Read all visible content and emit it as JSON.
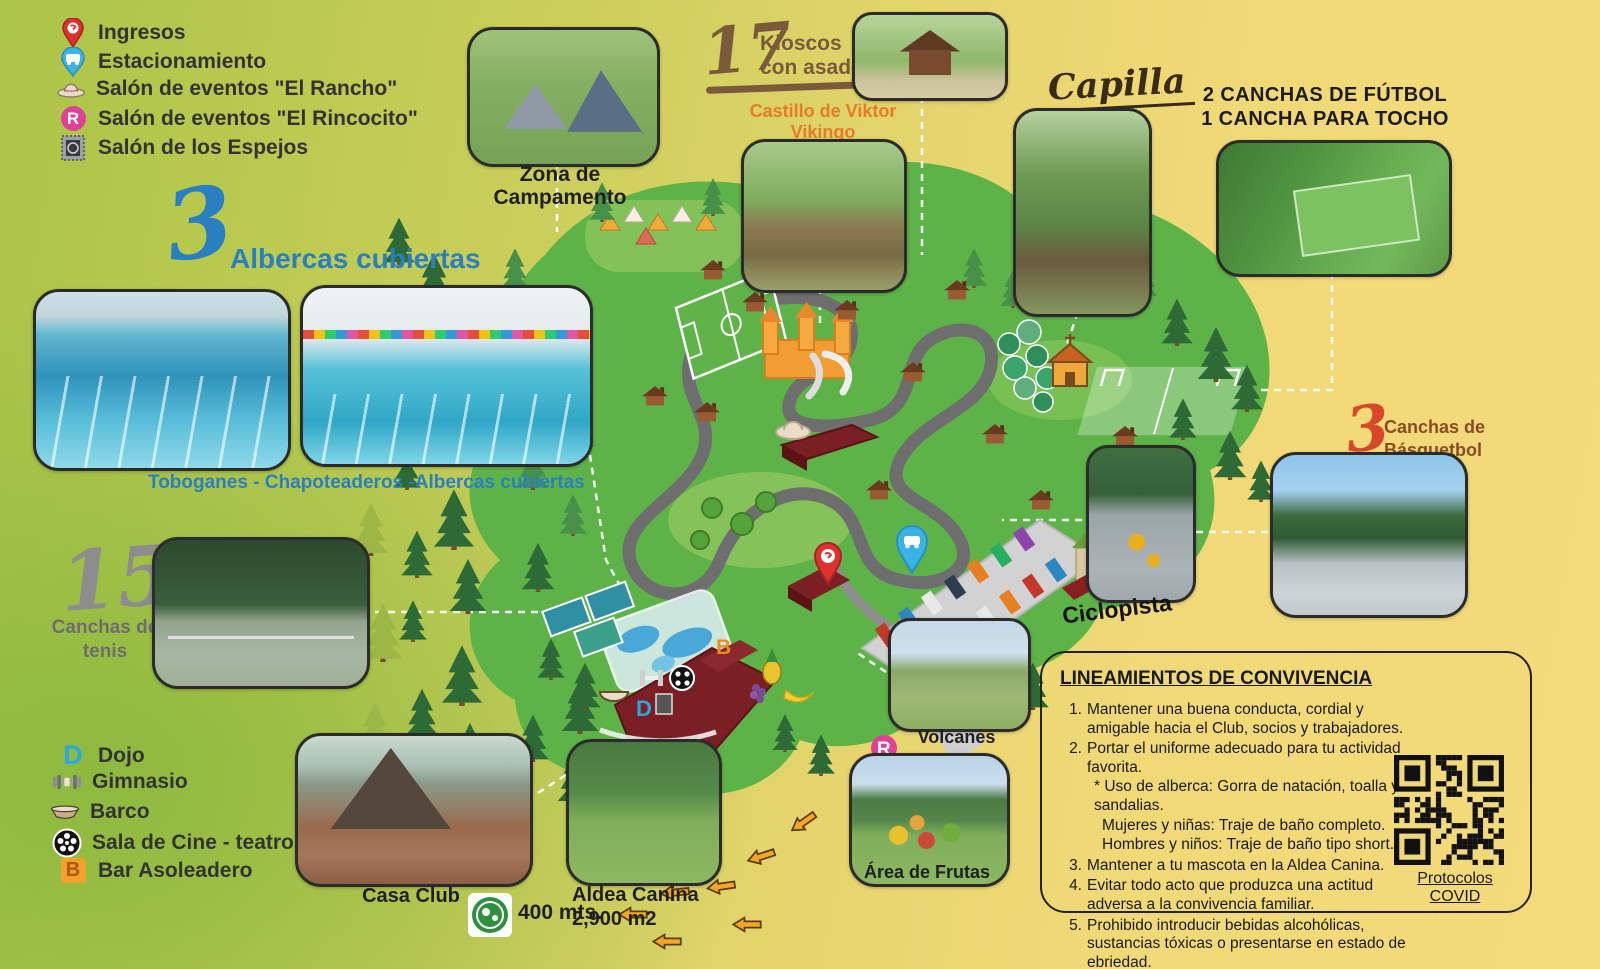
{
  "legend_top": {
    "items": [
      {
        "icon": "location-pin",
        "label": "Ingresos"
      },
      {
        "icon": "parking-pin",
        "label": "Estacionamiento"
      },
      {
        "icon": "cowboy-hat",
        "label": "Salón de eventos \"El Rancho\""
      },
      {
        "icon": "r-badge",
        "label": "Salón de eventos  \"El Rincocito\""
      },
      {
        "icon": "mirrors",
        "label": "Salón de los Espejos"
      }
    ]
  },
  "legend_bottom": {
    "items": [
      {
        "icon": "d-letter",
        "label": "Dojo"
      },
      {
        "icon": "dumbbell",
        "label": "Gimnasio"
      },
      {
        "icon": "boat",
        "label": "Barco"
      },
      {
        "icon": "film-reel",
        "label": "Sala de Cine - teatro"
      },
      {
        "icon": "b-letter",
        "label": "Bar Asoleadero"
      }
    ]
  },
  "sections": {
    "albercas": {
      "count": "3",
      "title": "Albercas cubiertas",
      "caption": "Toboganes - Chapoteaderos -Albercas cubiertas"
    },
    "tenis": {
      "count": "15",
      "label": "Canchas de tenis"
    },
    "campamento": {
      "label": "Zona de Campamento"
    },
    "kioscos": {
      "count": "17",
      "label": "Kioscos con asador"
    },
    "castillo": {
      "label": "Castillo de Viktor Vikingo"
    },
    "capilla": {
      "label": "Capilla"
    },
    "futbol": {
      "line1": "2 CANCHAS DE FÚTBOL",
      "line2": "1 CANCHA PARA TOCHO"
    },
    "basquetbol": {
      "count": "3",
      "label": "Canchas de Básquetbol"
    },
    "ciclopista": {
      "label": "Ciclopista"
    },
    "volcanes": {
      "label": "Volcanes"
    },
    "frutas": {
      "label": "Área de Frutas"
    },
    "aldea": {
      "label": "Aldea Canina",
      "area": "2,900 m2"
    },
    "casa_club": {
      "label": "Casa Club"
    },
    "distancia": {
      "label": "400 mts."
    }
  },
  "map_badges": {
    "dojo": "D",
    "bar": "B",
    "rincocito": "R"
  },
  "lineamientos": {
    "title": "LINEAMIENTOS DE CONVIVENCIA",
    "rules": [
      {
        "num": "1.",
        "text": "Mantener una buena conducta, cordial y amigable hacia el Club, socios y trabajadores."
      },
      {
        "num": "2.",
        "text": "Portar el uniforme adecuado para tu actividad favorita.",
        "subs": [
          "* Uso de alberca: Gorra de natación, toalla y sandalias.",
          "Mujeres y niñas: Traje de baño completo.",
          "Hombres y niños: Traje de baño tipo short."
        ]
      },
      {
        "num": "3.",
        "text": "Mantener a tu mascota en la Aldea Canina."
      },
      {
        "num": "4.",
        "text": "Evitar todo acto que produzca una actitud adversa a la convivencia familiar."
      },
      {
        "num": "5.",
        "text": "Prohibido introducir bebidas alcohólicas, sustancias tóxicas o presentarse en estado de ebriedad."
      }
    ],
    "qr_label": "Protocolos COVID"
  },
  "colors": {
    "accent_blue": "#2a7fc0",
    "accent_brown": "#7a5a3a",
    "accent_orange": "#e87b28",
    "accent_red": "#d9472b",
    "label_dark": "#1f1f1f",
    "map_green": "#5eb348"
  }
}
